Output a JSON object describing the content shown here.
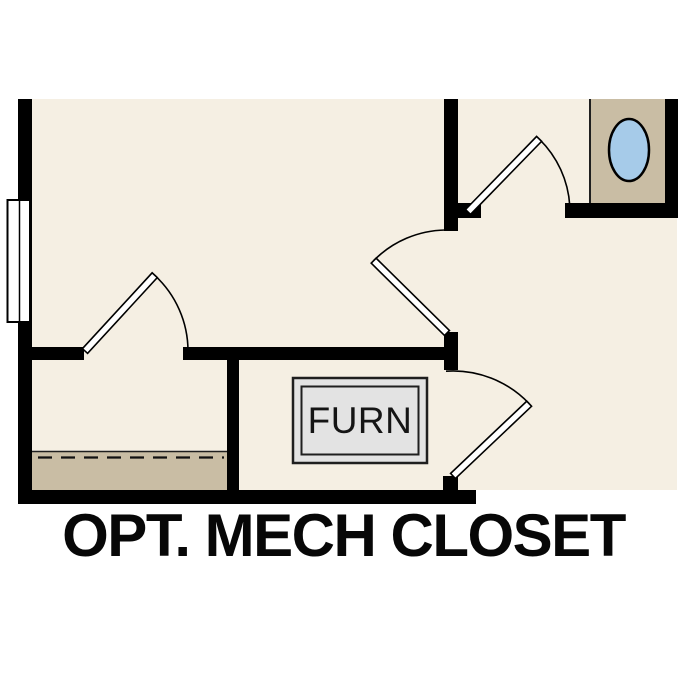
{
  "plan": {
    "caption": "OPT. MECH CLOSET",
    "furnace_label": "FURN",
    "colors": {
      "floor": "#f5efe3",
      "tan": "#c9bda4",
      "wall": "#000000",
      "fixture_blue": "#a6cbe9",
      "furnace_fill": "#e3e3e3",
      "outline": "#1f1f1f"
    }
  }
}
